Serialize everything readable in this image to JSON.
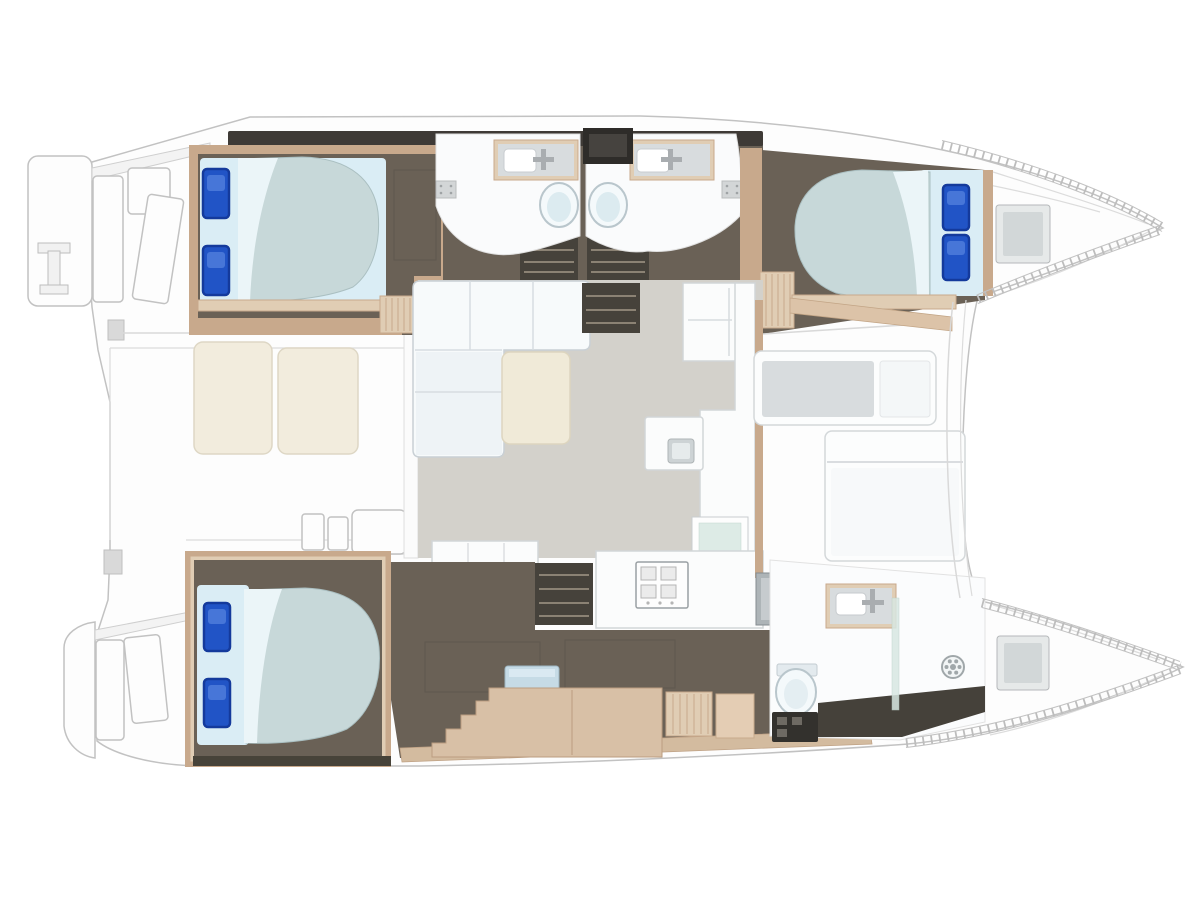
{
  "diagram": {
    "kind": "catamaran-yacht-floor-plan",
    "orientation": "bows-pointing-right",
    "hull_count": 2,
    "double_berths": 3,
    "berth_pillows_per_bed": 2,
    "bathrooms": 3,
    "toilets": 3,
    "sinks": 3,
    "shower_drains": 3,
    "stove_burners": 4,
    "rooms": [
      "stern-platforms",
      "aft-cockpit",
      "upper-hull-aft-cabin",
      "upper-hull-bathroom-left",
      "upper-hull-bathroom-right",
      "upper-hull-forward-cabin",
      "saloon-with-sofa-and-table",
      "galley-with-island-and-stove",
      "companionway-stairs",
      "lower-hull-aft-cabin",
      "lower-hull-desk-area",
      "lower-hull-bathroom",
      "forward-cockpit",
      "bow-storage-lockers"
    ]
  },
  "colors": {
    "hullOutline": "#c2c2c2",
    "deckWhite": "#fdfdfd",
    "panelGray": "#f3f3f3",
    "darkBand": "#3e3a36",
    "woodTrim": "#c8a98c",
    "woodLight": "#e0cdb4",
    "woodDesk": "#d8c0a6",
    "woodBand": "#d3bb9f",
    "floorDark": "#6a6156",
    "stairDark": "#46423b",
    "stairStep": "#8b8274",
    "saloonFloor": "#d3d1cb",
    "mattress": "#c7d8d9",
    "sheet": "#daedf5",
    "fold": "#ebf5f8",
    "pillow": "#2154c6",
    "pillowEdge": "#143a9c",
    "pillowLight": "#4d7cdb",
    "tableCream": "#f0ead8",
    "benchCream": "#f2ecdd",
    "sofaWhite": "#f7fafb",
    "seatGrayInset": "#d8dcde",
    "counterWhite": "#fbfcfc",
    "steel": "#adb4b7",
    "steelLight": "#c6cbce",
    "glass": "#d8e8e2",
    "toilet": "#f4f9fb",
    "toiletRim": "#b9c6cc",
    "stoolBlue": "#c6dbe6",
    "hatchGray": "#e6e9e9",
    "hatchInner": "#d2d7d8",
    "drainGray": "#a0a7aa",
    "tickGray": "#bdbdbd",
    "lineLight": "#dcdcdc"
  }
}
